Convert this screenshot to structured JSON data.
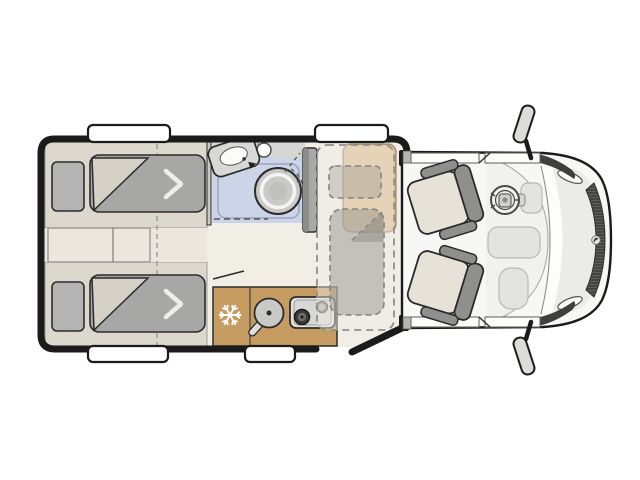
{
  "colors": {
    "background": "#ffffff",
    "wall": "#1b1b1b",
    "floor": "#f1eee6",
    "bed_platform": "#dcd8cd",
    "aisle": "#ebe7de",
    "pillow": "#b4b4b2",
    "duvet": "#a7a7a5",
    "duvet_fold": "#d5d1c7",
    "bath_cabinet": "#d6d6d4",
    "shower_floor": "#ccd4e8",
    "toilet": "#c9c9c7",
    "wardrobe": "#a9a9a7",
    "kitchen_counter": "#c69c63",
    "bench": "#ddbf92",
    "overlay_fill": "rgba(238,236,229,0.45)",
    "overlay_stroke": "#90908a",
    "seat_cushion": "#e7e2d8",
    "seat_frame": "#8f8f8d",
    "cab_body": "#f7f7f5",
    "hood": "#ebebe9",
    "grille": "#5f5f5d",
    "mirror": "#dcdcda",
    "window": "#ffffff",
    "snowflake": "#ffffff"
  },
  "floorplan": {
    "view": "top-down-motorhome-layout",
    "rooms": [
      {
        "name": "rear-bedroom",
        "furniture": [
          "single-bed-top",
          "single-bed-bottom",
          "center-steps"
        ]
      },
      {
        "name": "bathroom",
        "furniture": [
          "washbasin",
          "swivel-toilet",
          "shower-tray"
        ]
      },
      {
        "name": "wardrobe",
        "furniture": [
          "tall-cabinet"
        ]
      },
      {
        "name": "kitchen",
        "furniture": [
          "refrigerator",
          "round-sink",
          "two-burner-stove"
        ]
      },
      {
        "name": "lounge",
        "furniture": [
          "bench-seat",
          "drop-down-bed"
        ]
      },
      {
        "name": "cab",
        "furniture": [
          "passenger-swivel-seat",
          "driver-swivel-seat",
          "steering-wheel",
          "dashboard",
          "side-mirror-top",
          "side-mirror-bottom"
        ]
      }
    ],
    "openings": [
      "window-bedroom-top",
      "window-lounge-top",
      "window-bedroom-bottom",
      "window-kitchen-bottom",
      "entry-door-gap",
      "cab-door-top",
      "cab-door-bottom"
    ]
  },
  "icons": [
    {
      "name": "snowflake-icon",
      "meaning": "refrigerator-freezer"
    }
  ]
}
